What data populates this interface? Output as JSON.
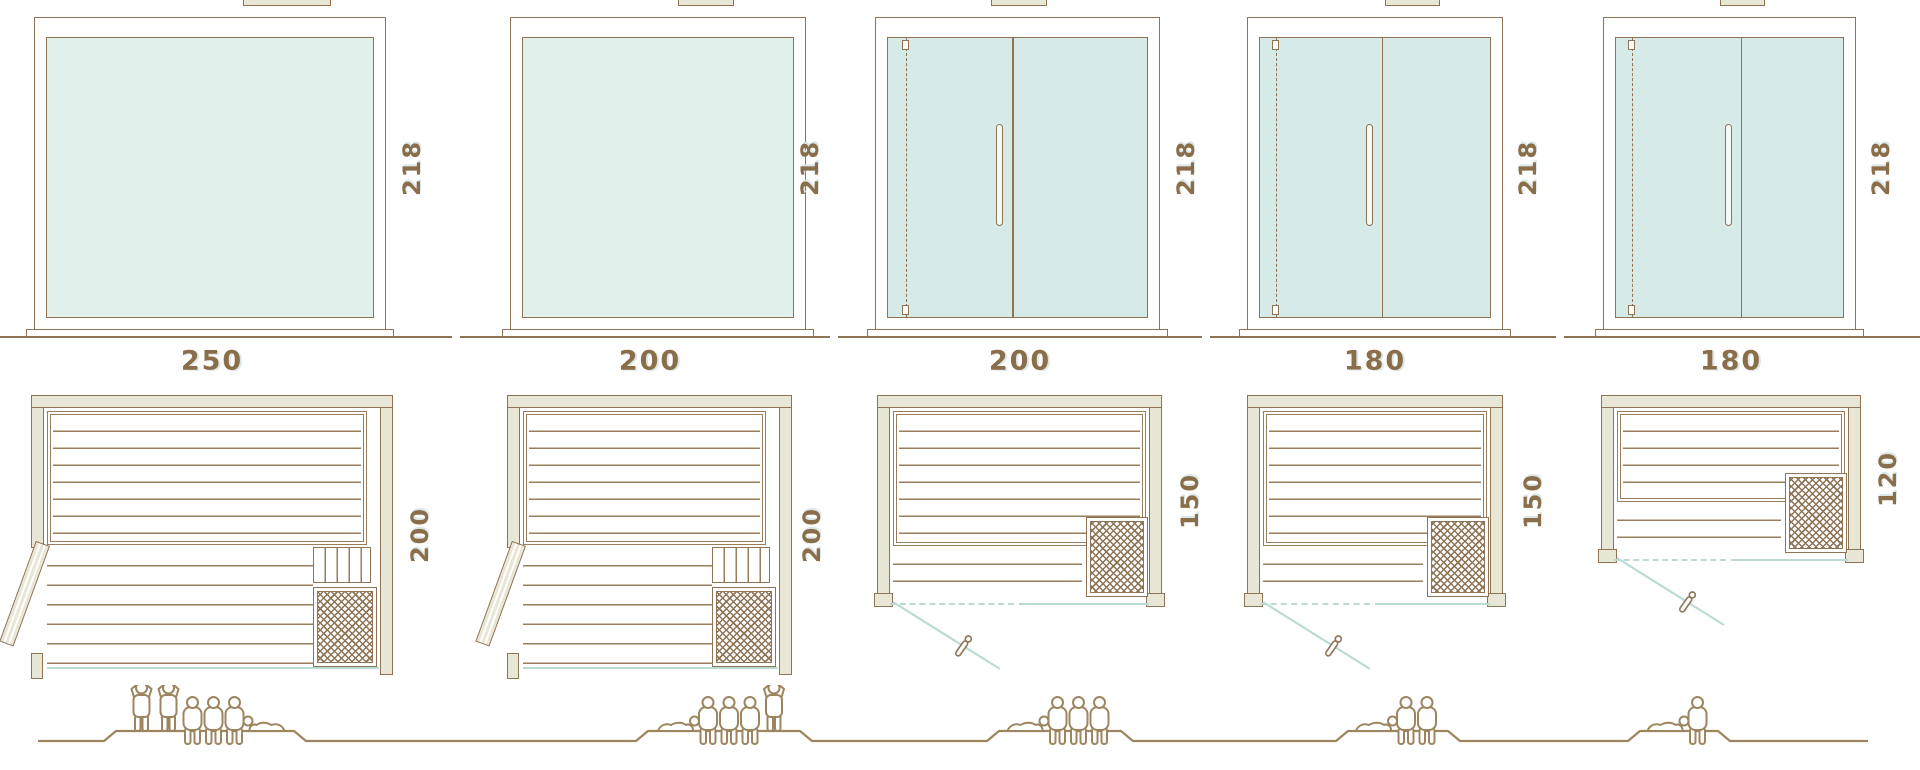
{
  "colors": {
    "line": "#8e7355",
    "slat_line": "#9a7e5b",
    "wall_fill": "#e8e6d4",
    "glass_fill": "#e2f0ec",
    "glass_door_fill": "#d6ebe7",
    "teal_accent": "#bcdad4",
    "label_text": "#8a6e49",
    "figure_outline": "#9d8560"
  },
  "saunas": [
    {
      "name": "sauna-250x200",
      "width_label": "250",
      "height_label": "218",
      "depth_label": "200",
      "front_type": "fixed-glass-front",
      "plan_door": "hinged-door-open-left",
      "capacity": {
        "standing": 2,
        "sitting": 3,
        "lying": 1
      },
      "people": [
        "standing",
        "standing",
        "sitting",
        "sitting",
        "sitting",
        "lying-l"
      ]
    },
    {
      "name": "sauna-200x200",
      "width_label": "200",
      "height_label": "218",
      "depth_label": "200",
      "front_type": "fixed-glass-front",
      "plan_door": "hinged-door-open-left",
      "capacity": {
        "standing": 1,
        "sitting": 3,
        "lying": 1
      },
      "people": [
        "lying-r",
        "sitting",
        "sitting",
        "sitting",
        "standing"
      ]
    },
    {
      "name": "sauna-200x150",
      "width_label": "200",
      "height_label": "218",
      "depth_label": "150",
      "front_type": "glass-door-front",
      "plan_door": "front-swing-door",
      "capacity": {
        "standing": 0,
        "sitting": 3,
        "lying": 1
      },
      "people": [
        "lying-r",
        "sitting",
        "sitting",
        "sitting"
      ]
    },
    {
      "name": "sauna-180x150",
      "width_label": "180",
      "height_label": "218",
      "depth_label": "150",
      "front_type": "glass-door-front",
      "plan_door": "front-swing-door",
      "capacity": {
        "standing": 0,
        "sitting": 2,
        "lying": 1
      },
      "people": [
        "lying-r",
        "sitting",
        "sitting"
      ]
    },
    {
      "name": "sauna-180x120",
      "width_label": "180",
      "height_label": "218",
      "depth_label": "120",
      "front_type": "glass-door-front",
      "plan_door": "front-swing-door",
      "capacity": {
        "standing": 0,
        "sitting": 1,
        "lying": 1
      },
      "people": [
        "lying-r",
        "sitting"
      ]
    }
  ]
}
